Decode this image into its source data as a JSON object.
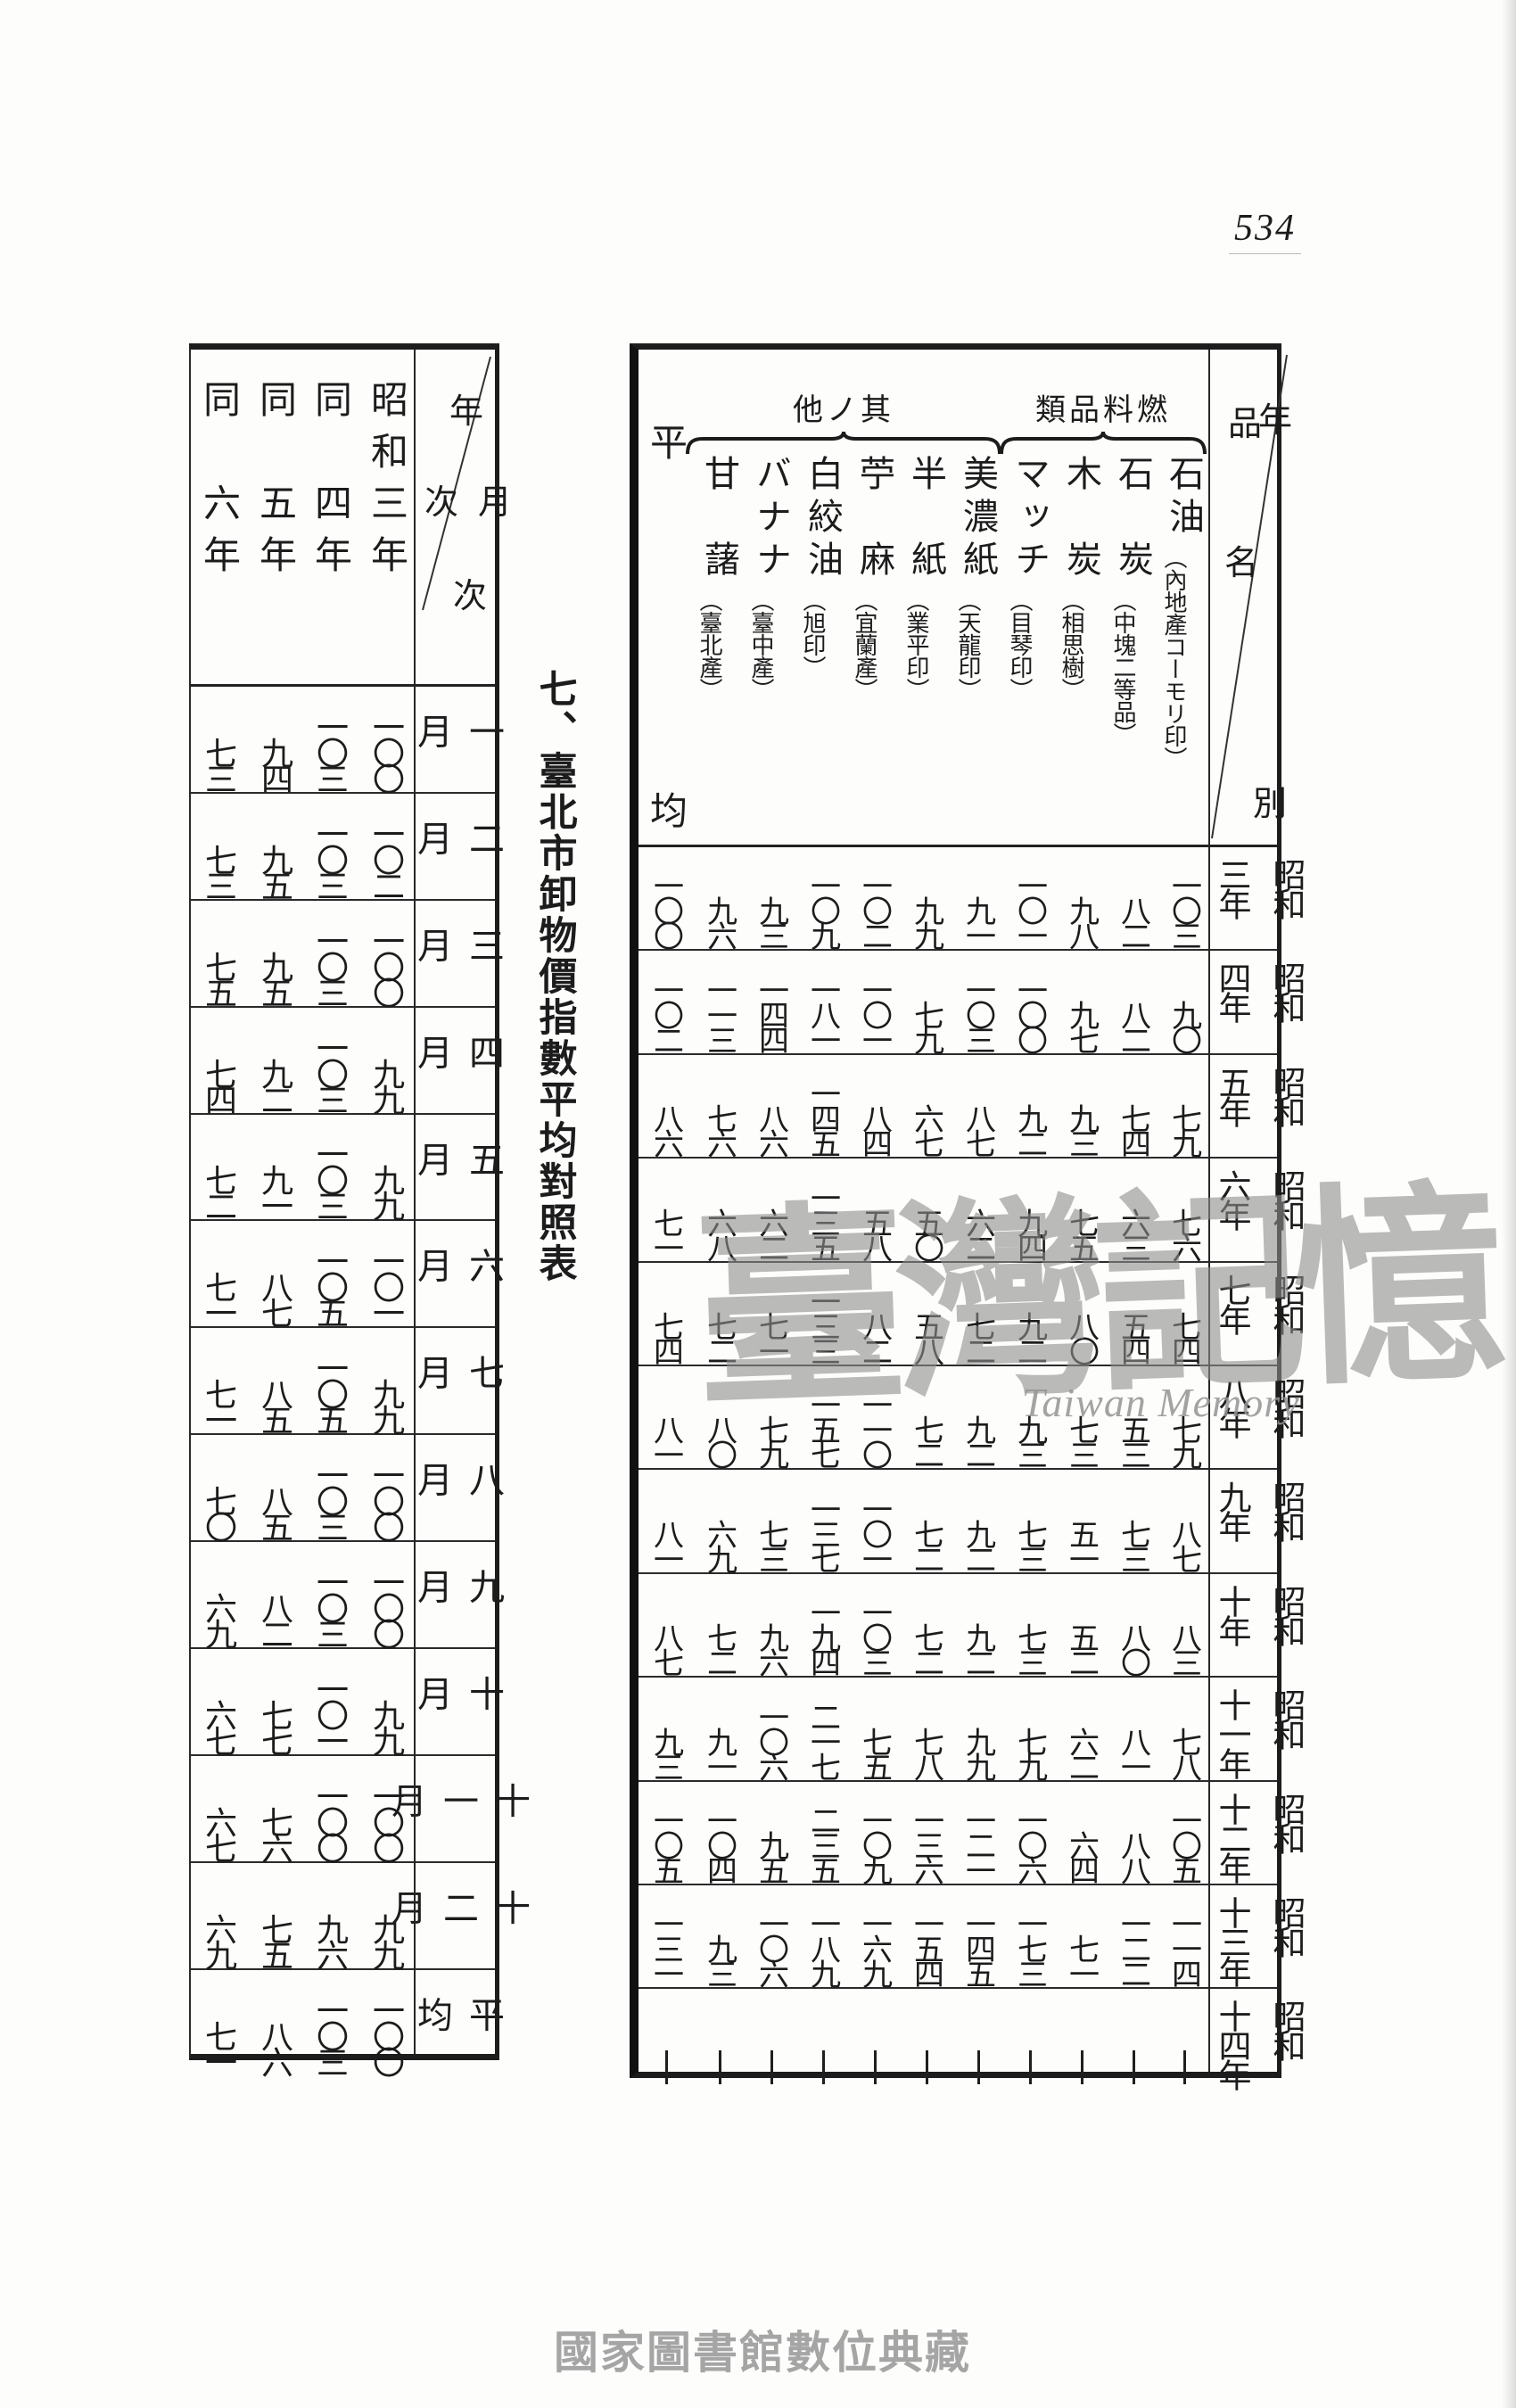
{
  "page": {
    "number": "534",
    "watermark_cjk": "臺灣記憶",
    "watermark_latin": "Taiwan Memory",
    "footer_watermark": "國家圖書館數位典藏"
  },
  "title": "七、臺北市卸物價指數平均對照表",
  "left_table": {
    "corner": {
      "col_top": "年",
      "col_bottom": "次",
      "row_top": "月",
      "row_bottom": "次"
    },
    "columns": [
      "昭和三年",
      "同　四年",
      "同　五年",
      "同　六年"
    ],
    "rows": [
      {
        "label": "一月",
        "values": [
          "一〇〇",
          "一〇三",
          "九四",
          "七三"
        ]
      },
      {
        "label": "二月",
        "values": [
          "一〇二",
          "一〇三",
          "九五",
          "七三"
        ]
      },
      {
        "label": "三月",
        "values": [
          "一〇〇",
          "一〇三",
          "九五",
          "七五"
        ]
      },
      {
        "label": "四月",
        "values": [
          "九九",
          "一〇三",
          "九二",
          "七四"
        ]
      },
      {
        "label": "五月",
        "values": [
          "九九",
          "一〇三",
          "九一",
          "七二"
        ]
      },
      {
        "label": "六月",
        "values": [
          "一〇一",
          "一〇五",
          "八七",
          "七一"
        ]
      },
      {
        "label": "七月",
        "values": [
          "九九",
          "一〇五",
          "八五",
          "七一"
        ]
      },
      {
        "label": "八月",
        "values": [
          "一〇〇",
          "一〇三",
          "八五",
          "七〇"
        ]
      },
      {
        "label": "九月",
        "values": [
          "一〇〇",
          "一〇三",
          "八二",
          "六九"
        ]
      },
      {
        "label": "十月",
        "values": [
          "九九",
          "一〇一",
          "七七",
          "六七"
        ]
      },
      {
        "label": "十一月",
        "values": [
          "一〇〇",
          "一〇〇",
          "七六",
          "六七"
        ]
      },
      {
        "label": "十二月",
        "values": [
          "九九",
          "九六",
          "七五",
          "六九"
        ]
      },
      {
        "label": "平均",
        "values": [
          "一〇〇",
          "一〇三",
          "八六",
          "七一"
        ]
      }
    ]
  },
  "right_table": {
    "corner": {
      "col_top": "品",
      "col_bottom": "名",
      "row_top": "年",
      "row_bottom": "別"
    },
    "groups": {
      "fuel": "類品料燃",
      "other": "他ノ其"
    },
    "columns": [
      {
        "main": "石油",
        "note": "︵內地產コーモリ印︶"
      },
      {
        "main": "石　炭",
        "note": "︵中塊二等品︶"
      },
      {
        "main": "木　炭",
        "note": "︵相思樹︶"
      },
      {
        "main": "マッチ",
        "note": "︵目琴印︶"
      },
      {
        "main": "美濃紙",
        "note": "︵天龍印︶"
      },
      {
        "main": "半　紙",
        "note": "︵業平印︶"
      },
      {
        "main": "苧　麻",
        "note": "︵宜蘭產︶"
      },
      {
        "main": "白絞油",
        "note": "︵旭印︶"
      },
      {
        "main": "バナナ",
        "note": "︵臺中產︶"
      },
      {
        "main": "甘　藷",
        "note": "︵臺北產︶"
      },
      {
        "top": "平",
        "bottom": "均"
      }
    ],
    "rows": [
      {
        "era": "昭和",
        "year": "三年",
        "values": [
          "一〇三",
          "八二",
          "九八",
          "一〇一",
          "九一",
          "九九",
          "一〇二",
          "一〇九",
          "九三",
          "九六",
          "一〇〇"
        ]
      },
      {
        "era": "昭和",
        "year": "四年",
        "values": [
          "九〇",
          "八二",
          "九七",
          "一〇〇",
          "一〇三",
          "七九",
          "一〇一",
          "一八一",
          "一四四",
          "一一三",
          "一〇二"
        ]
      },
      {
        "era": "昭和",
        "year": "五年",
        "values": [
          "七九",
          "七四",
          "九三",
          "九二",
          "八七",
          "六七",
          "八四",
          "一四五",
          "八六",
          "七六",
          "八六"
        ]
      },
      {
        "era": "昭和",
        "year": "六年",
        "values": [
          "七六",
          "六三",
          "七五",
          "九四",
          "六二",
          "五〇",
          "五八",
          "一三五",
          "六二",
          "六八",
          "七一"
        ]
      },
      {
        "era": "昭和",
        "year": "七年",
        "values": [
          "七四",
          "五四",
          "八〇",
          "九二",
          "七二",
          "五八",
          "八二",
          "一三三",
          "七一",
          "七二",
          "七四"
        ]
      },
      {
        "era": "昭和",
        "year": "八年",
        "values": [
          "七九",
          "五三",
          "七三",
          "九三",
          "九二",
          "七二",
          "一一〇",
          "一五七",
          "七九",
          "八〇",
          "八一"
        ]
      },
      {
        "era": "昭和",
        "year": "九年",
        "values": [
          "八七",
          "七三",
          "五一",
          "七三",
          "九二",
          "七二",
          "一〇一",
          "一三七",
          "七三",
          "六九",
          "八一"
        ]
      },
      {
        "era": "昭和",
        "year": "十年",
        "values": [
          "八三",
          "八〇",
          "五二",
          "七三",
          "九二",
          "七二",
          "一〇三",
          "一九四",
          "九六",
          "七二",
          "八七"
        ]
      },
      {
        "era": "昭和",
        "year": "十一年",
        "values": [
          "七八",
          "八一",
          "六二",
          "七九",
          "九九",
          "七八",
          "七五",
          "二一七",
          "一〇六",
          "九一",
          "九三"
        ]
      },
      {
        "era": "昭和",
        "year": "十二年",
        "values": [
          "一〇五",
          "八八",
          "六四",
          "一〇六",
          "一二一",
          "一三六",
          "一〇九",
          "二三五",
          "九五",
          "一〇四",
          "一〇五"
        ]
      },
      {
        "era": "昭和",
        "year": "十三年",
        "values": [
          "一一四",
          "一二二",
          "七一",
          "一七三",
          "一四五",
          "一五四",
          "一六九",
          "一八九",
          "一〇六",
          "九三",
          "一三一"
        ]
      },
      {
        "era": "昭和",
        "year": "十四年",
        "ditto": true,
        "values": []
      }
    ]
  }
}
